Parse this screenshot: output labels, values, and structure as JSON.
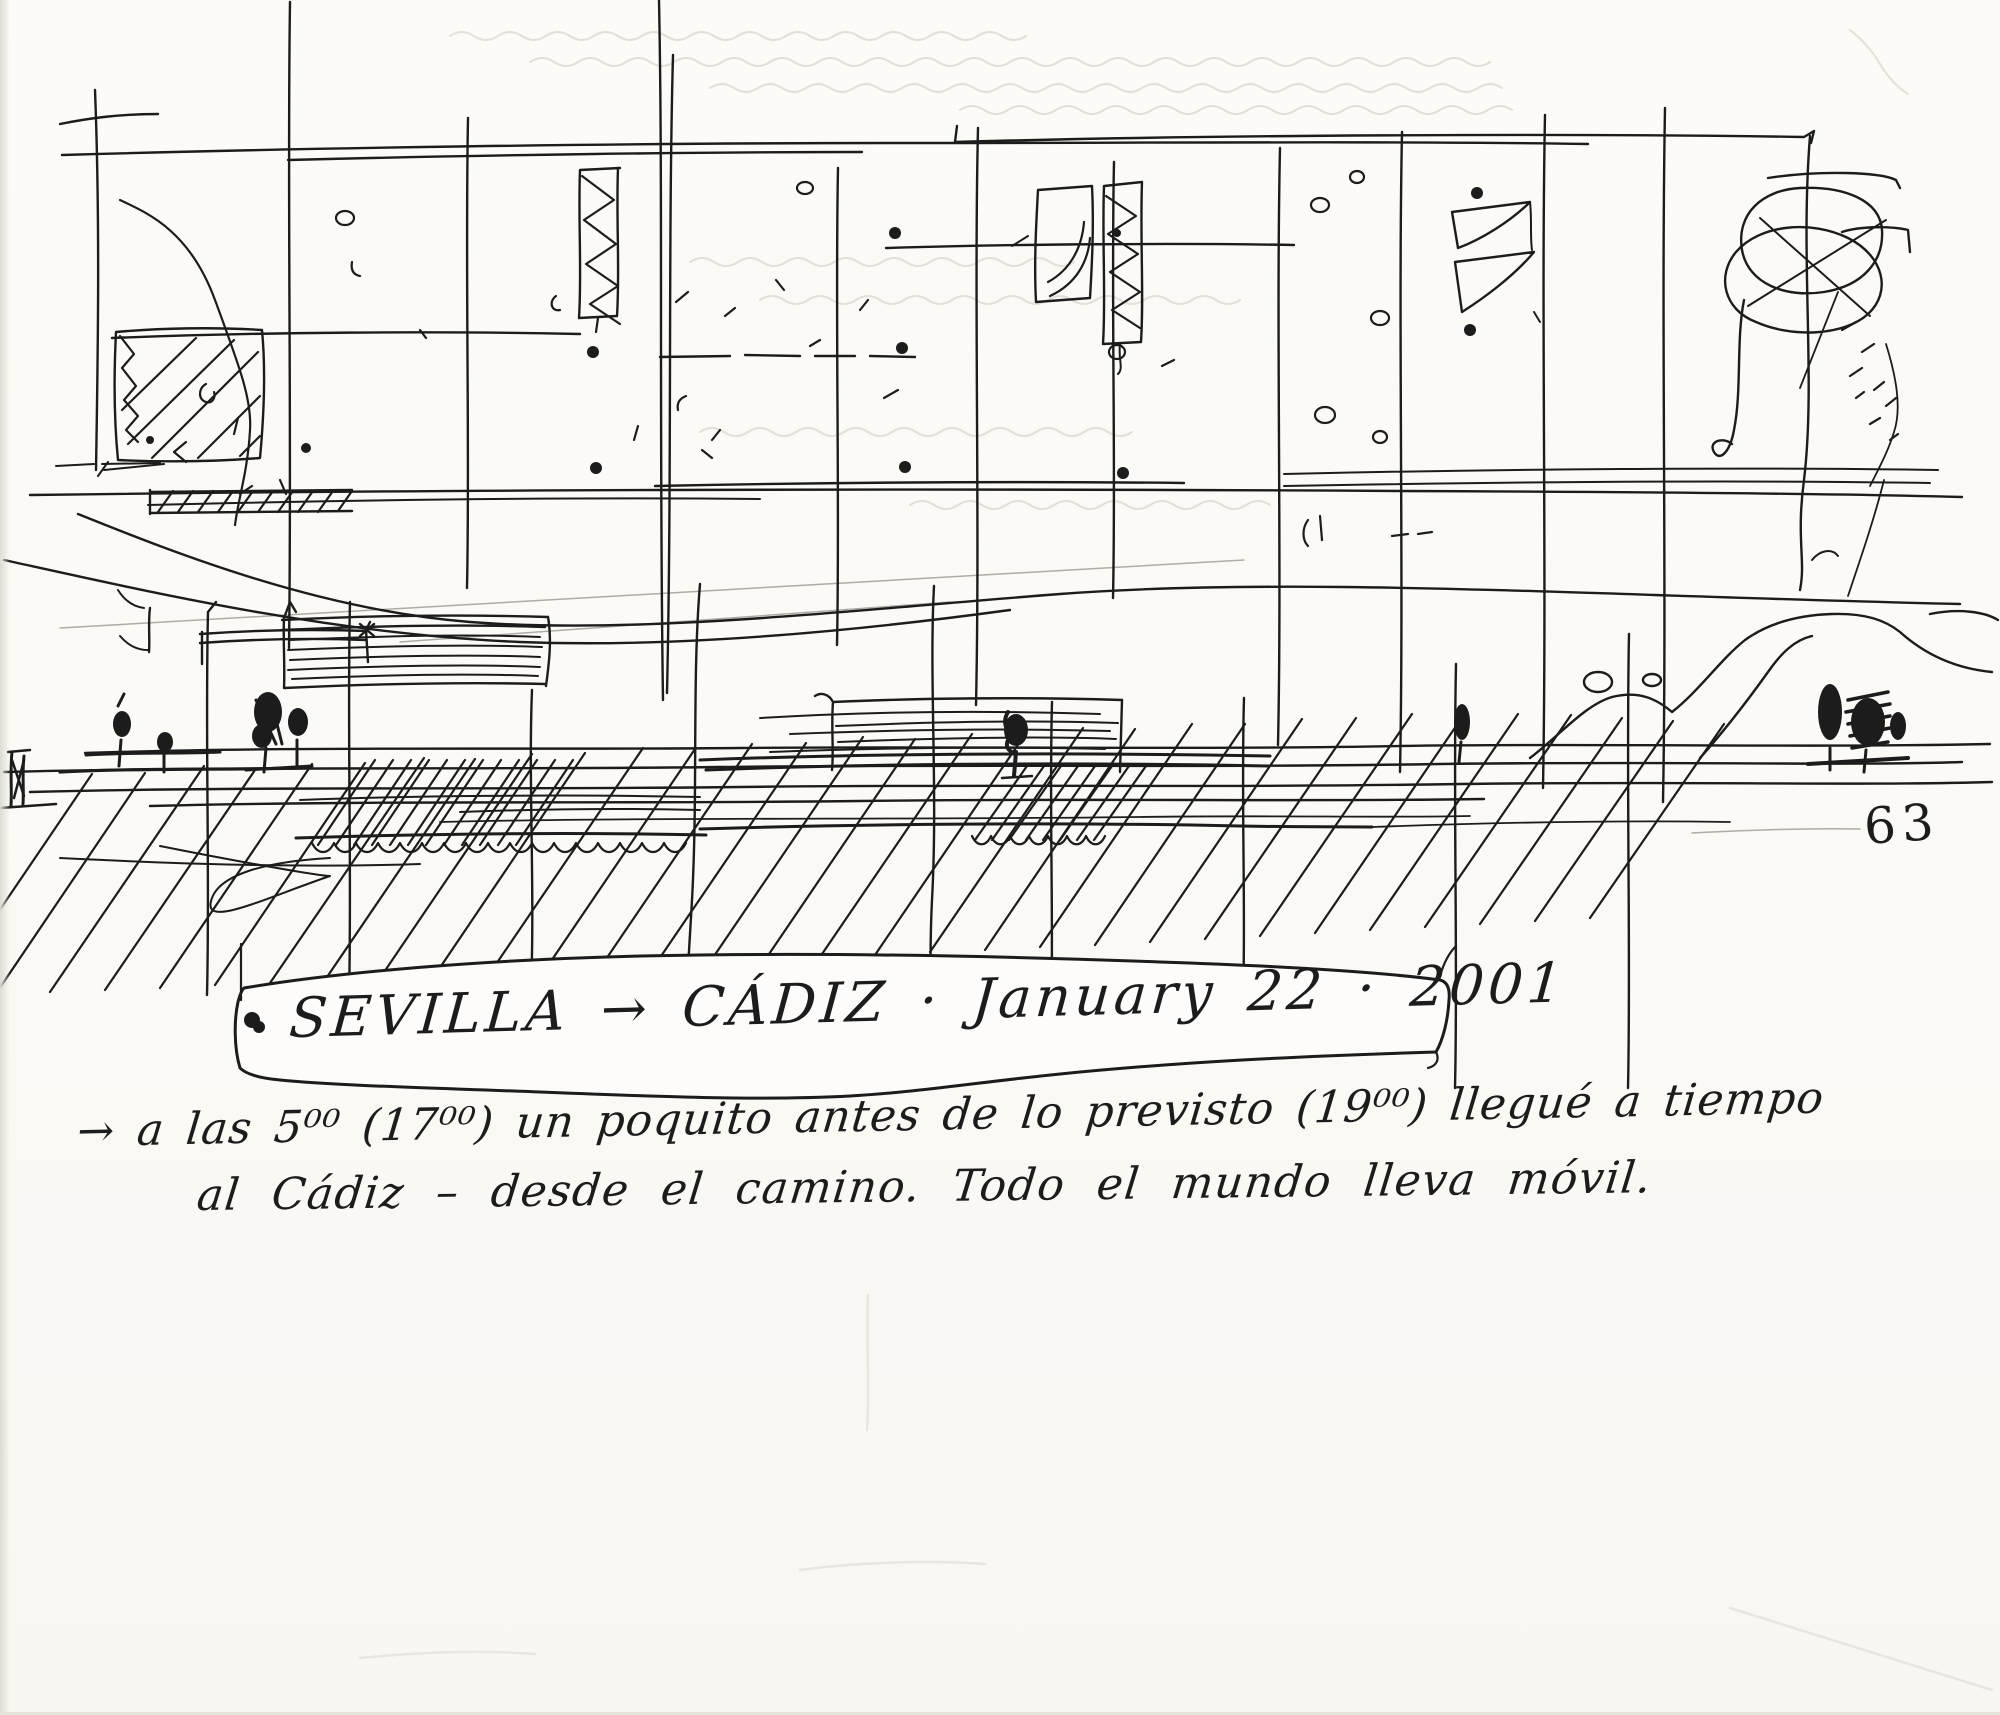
{
  "colors": {
    "paper": "#fbfaf6",
    "ink": "#1c1c1c",
    "faint": "#cdc9c0"
  },
  "caption": {
    "text": "SEVILLA → CÁDIZ · January 22 · 2001"
  },
  "notes": {
    "line1": "→ a las 5⁰⁰ (17⁰⁰) un poquito antes de lo previsto (19⁰⁰) llegué a tiempo",
    "line2": "al Cádiz – desde el camino. Todo el mundo lleva móvil."
  },
  "page_number": "63"
}
